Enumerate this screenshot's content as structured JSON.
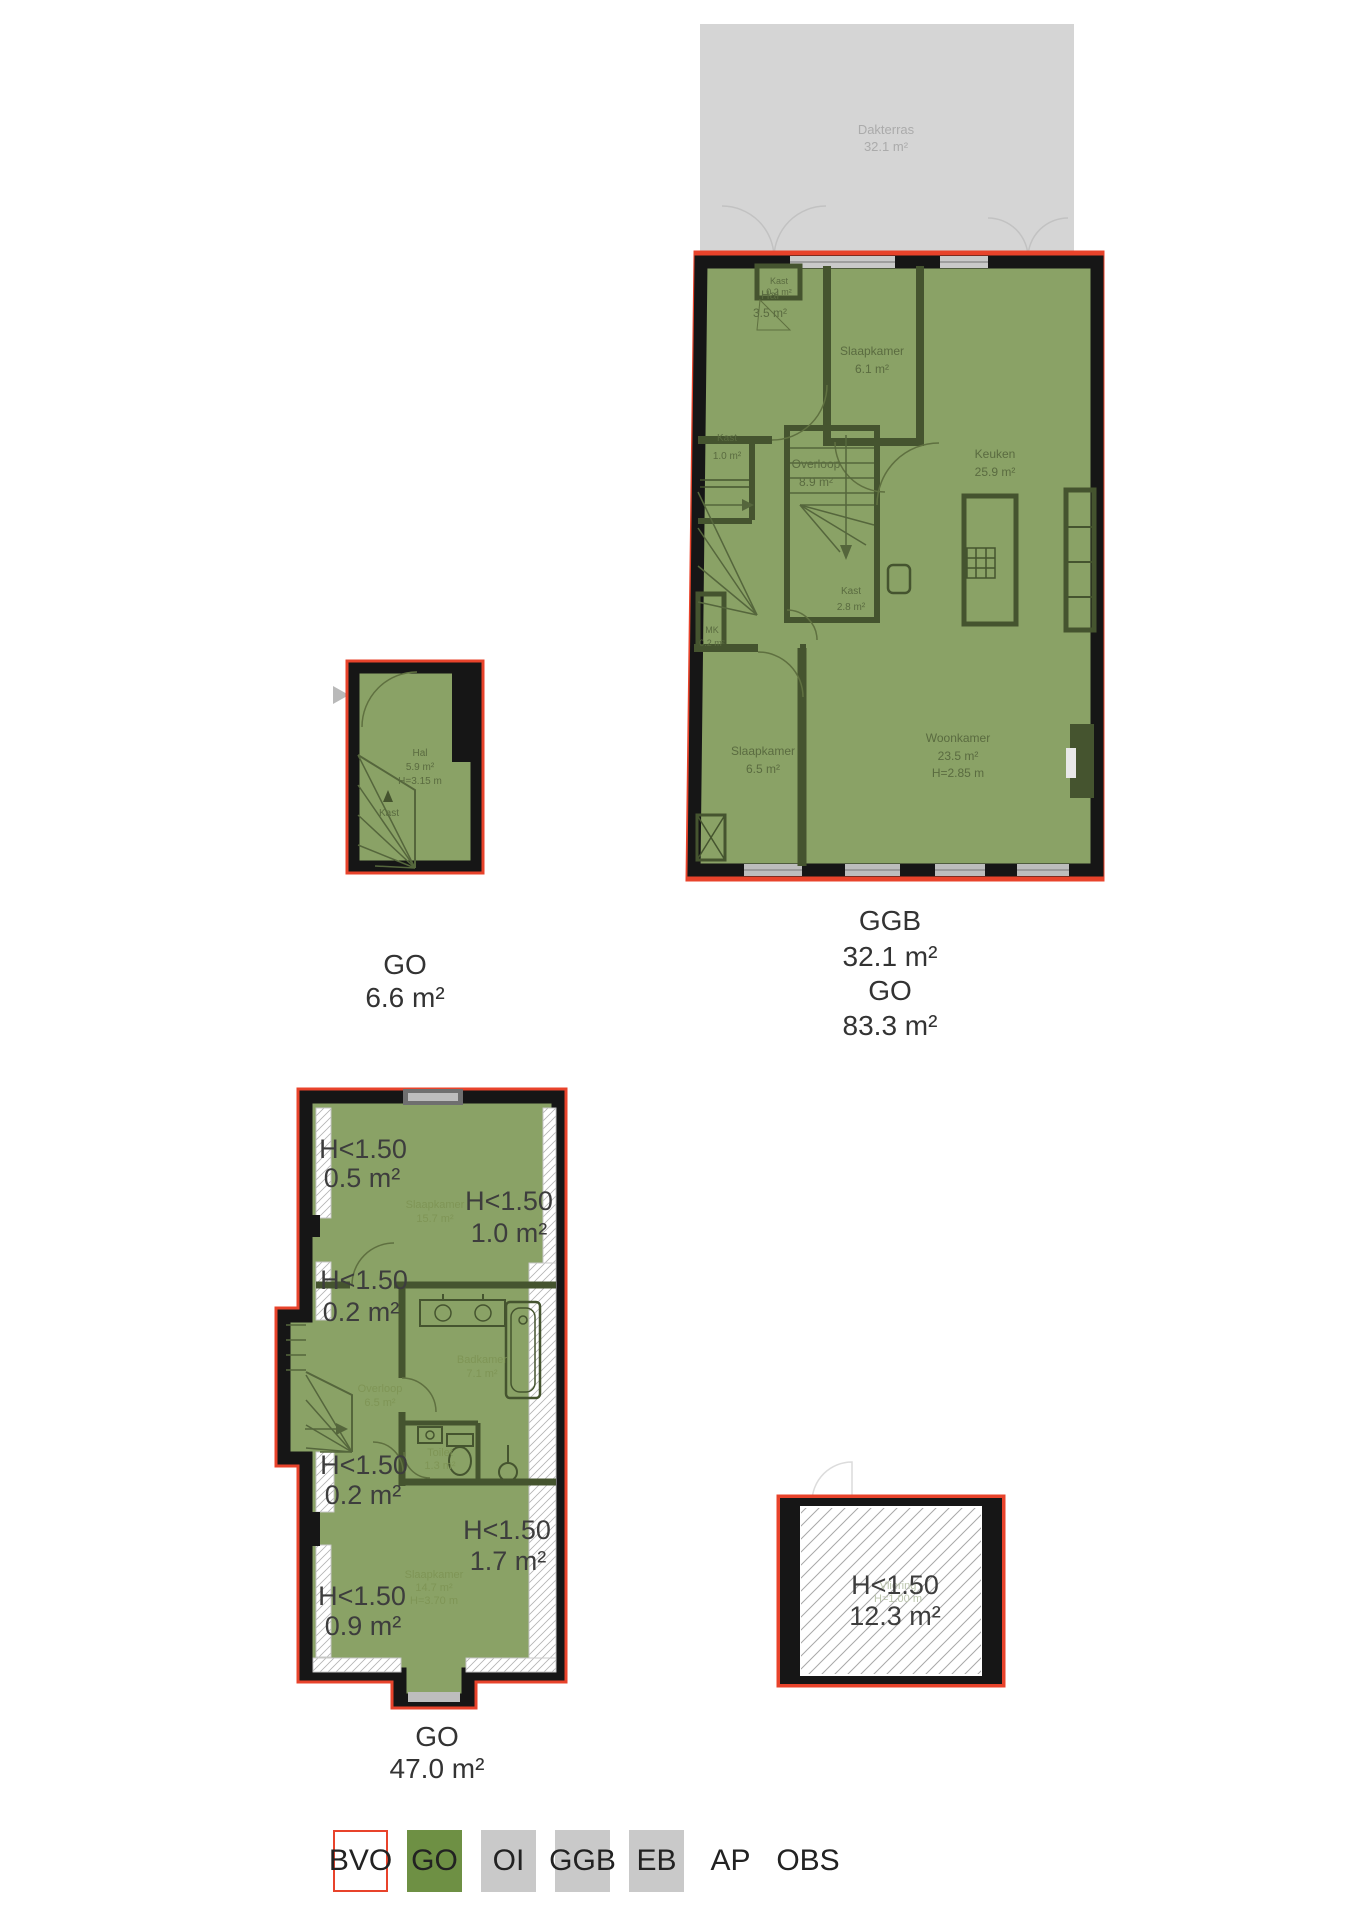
{
  "palette": {
    "bvo_red": "#e8432b",
    "go_green": "#6e9044",
    "legend_gray": "#c9c9c9",
    "plan_fill": "#8aa266",
    "terrace_gray": "#d5d5d5"
  },
  "main_plan": {
    "terrace": {
      "name": "Dakterras",
      "area": "32.1 m²"
    },
    "rooms": {
      "kast_top": {
        "name": "Kast",
        "area": "0.2 m²"
      },
      "hal": {
        "name": "Hal",
        "area": "3.5 m²"
      },
      "slaapkamer1": {
        "name": "Slaapkamer",
        "area": "6.1 m²"
      },
      "kast1": {
        "name": "Kast",
        "area": "1.0 m²"
      },
      "overloop": {
        "name": "Overloop",
        "area": "8.9 m²"
      },
      "keuken": {
        "name": "Keuken",
        "area": "25.9 m²"
      },
      "kast2": {
        "name": "Kast",
        "area": "2.8 m²"
      },
      "mk": {
        "name": "MK",
        "area": "0.2 m²"
      },
      "slaapkamer2": {
        "name": "Slaapkamer",
        "area": "6.5 m²"
      },
      "woonkamer": {
        "name": "Woonkamer",
        "area": "23.5 m²",
        "height": "H=2.85 m"
      }
    },
    "caption": {
      "line1": "GGB",
      "line2": "32.1 m²",
      "line3": "GO",
      "line4": "83.3 m²"
    }
  },
  "entry_plan": {
    "rooms": {
      "hal": {
        "name": "Hal",
        "area": "5.9 m²",
        "height": "H=3.15 m"
      },
      "kast": {
        "name": "Kast"
      }
    },
    "caption": {
      "line1": "GO",
      "line2": "6.6 m²"
    }
  },
  "upper_plan": {
    "rooms": {
      "slaapkamer1": {
        "name": "Slaapkamer",
        "area": "15.7 m²"
      },
      "overloop": {
        "name": "Overloop",
        "area": "6.5 m²"
      },
      "badkamer": {
        "name": "Badkamer",
        "area": "7.1 m²"
      },
      "toilet": {
        "name": "Toilet",
        "area": "1.3 m²"
      },
      "slaapkamer2": {
        "name": "Slaapkamer",
        "area": "14.7 m²",
        "height": "H=3.70 m"
      }
    },
    "low_headroom": {
      "l1": {
        "label": "H<1.50",
        "area": "0.5 m²"
      },
      "l2": {
        "label": "H<1.50",
        "area": "1.0 m²"
      },
      "l3": {
        "label": "H<1.50",
        "area": "0.2 m²"
      },
      "l4": {
        "label": "H<1.50",
        "area": "0.2 m²"
      },
      "l5": {
        "label": "H<1.50",
        "area": "1.7 m²"
      },
      "l6": {
        "label": "H<1.50",
        "area": "0.9 m²"
      }
    },
    "caption": {
      "line1": "GO",
      "line2": "47.0 m²"
    }
  },
  "attic_plan": {
    "low_headroom": {
      "label": "H<1.50",
      "area": "12.3 m²"
    },
    "faint": {
      "name": "Vliering",
      "height": "H=1.00 m"
    }
  },
  "legend": {
    "items": [
      {
        "label": "BVO",
        "swatch": "bvo"
      },
      {
        "label": "GO",
        "swatch": "go"
      },
      {
        "label": "OI",
        "swatch": "gray"
      },
      {
        "label": "GGB",
        "swatch": "gray"
      },
      {
        "label": "EB",
        "swatch": "gray"
      },
      {
        "label": "AP",
        "swatch": "none"
      },
      {
        "label": "OBS",
        "swatch": "none"
      }
    ]
  }
}
